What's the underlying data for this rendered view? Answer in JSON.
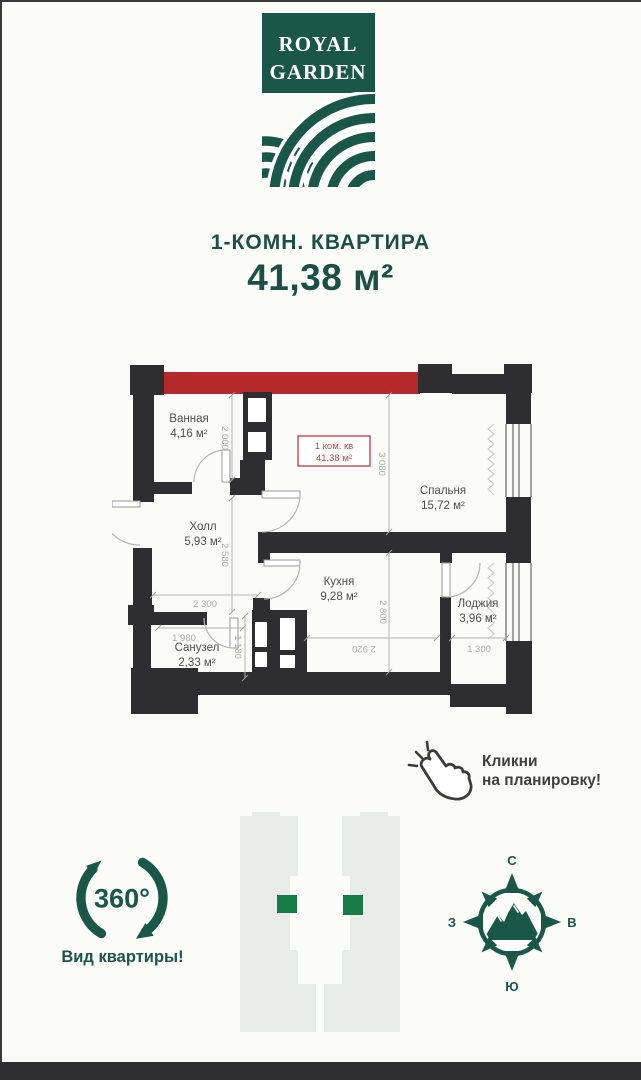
{
  "colors": {
    "brand": "#1b5749",
    "title": "#1c4f43",
    "accent_red": "#b5282c",
    "label_red": "#c4464b",
    "wall": "#2e2e30",
    "dim": "#a9a9a9",
    "room": "#4f4f4f",
    "hint": "#3f3f3f",
    "tower": "#e7ece8",
    "unit_square": "#177b45"
  },
  "logo": {
    "line1": "ROYAL",
    "line2": "GARDEN"
  },
  "header": {
    "title": "1-КОМН. КВАРТИРА",
    "area": "41,38 м²"
  },
  "plan": {
    "unit_label": {
      "line1": "1 ком. кв",
      "line2": "41,38 м²"
    },
    "rooms": [
      {
        "name": "Ванная",
        "area": "4,16 м²"
      },
      {
        "name": "Холл",
        "area": "5,93 м²"
      },
      {
        "name": "Санузел",
        "area": "2,33 м²"
      },
      {
        "name": "Кухня",
        "area": "9,28 м²"
      },
      {
        "name": "Спальня",
        "area": "15,72 м²"
      },
      {
        "name": "Лоджия",
        "area": "3,96 м²"
      }
    ],
    "dimensions": [
      "2 000",
      "2 580",
      "2 300",
      "1 980",
      "1 180",
      "3 080",
      "2 800",
      "2 920",
      "1 300"
    ]
  },
  "click_hint": {
    "line1": "Кликни",
    "line2": "на планировку!"
  },
  "view_360": {
    "badge": "360°",
    "label": "Вид квартиры!"
  },
  "compass": {
    "n": "С",
    "s": "Ю",
    "w": "З",
    "e": "В"
  }
}
